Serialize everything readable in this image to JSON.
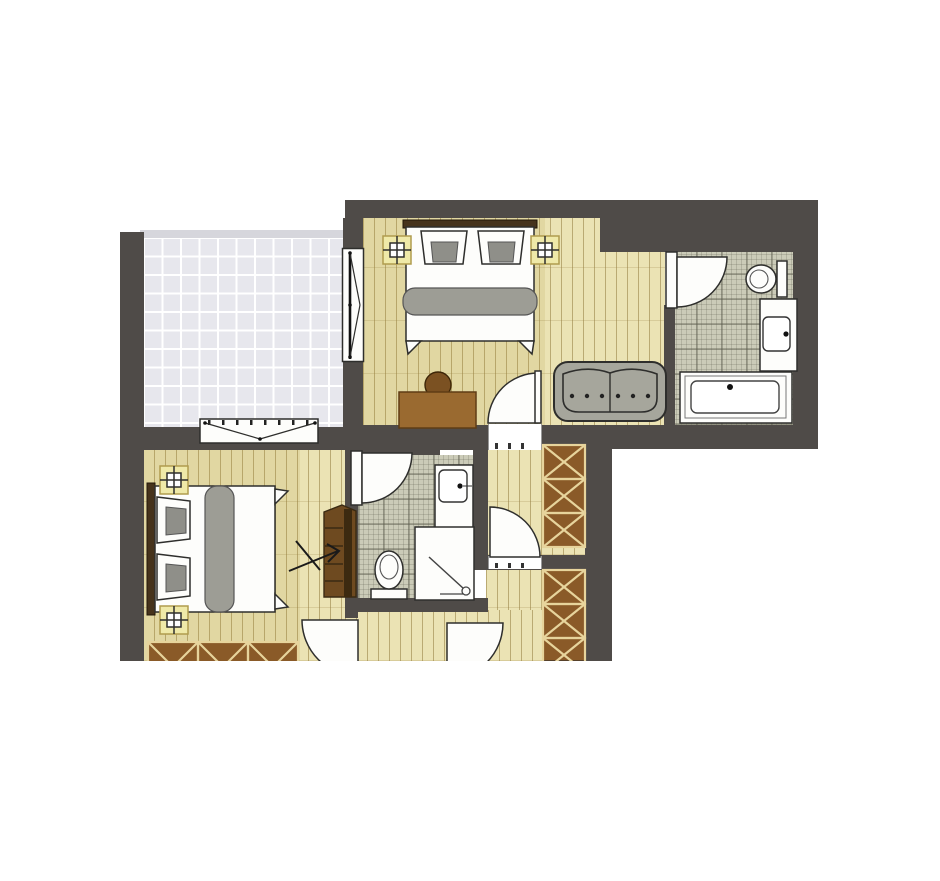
{
  "document": {
    "kind": "architectural-floor-plan",
    "visible_text": ""
  },
  "palette": {
    "wall": "#4f4b48",
    "outline": "#2e2e2c",
    "wood_floor": "#ebe3b4",
    "terrace_tile": "#e7e7ed",
    "bath_tile": "#cbcbb8",
    "fixture": "#fdfdfb",
    "textile": "#9d9d95",
    "sofa": "#a6a69c",
    "headboard": "#46331c",
    "desk": "#9a6a30",
    "chair": "#7b5122",
    "wardrobe": "#8a5a28",
    "wardrobe_hatch": "#e7d49c",
    "stairs": "#6e4a20",
    "light_fill": "#efe9a8",
    "light_border": "#b09c4e"
  },
  "rooms": [
    {
      "name": "terrace",
      "floor": "grey-tiles"
    },
    {
      "name": "bedroom-upper",
      "floor": "wood-planks"
    },
    {
      "name": "bathroom-upper",
      "floor": "checkered-tiles"
    },
    {
      "name": "bedroom-lower",
      "floor": "wood-planks"
    },
    {
      "name": "bathroom-lower",
      "floor": "checkered-tiles"
    },
    {
      "name": "hallway",
      "floor": "wood-planks"
    },
    {
      "name": "corridor",
      "floor": "wood-planks"
    }
  ],
  "furniture": [
    {
      "name": "double-bed",
      "room": "bedroom-upper"
    },
    {
      "name": "double-bed",
      "room": "bedroom-lower"
    },
    {
      "name": "sofa-two-seat",
      "room": "bedroom-upper"
    },
    {
      "name": "desk",
      "room": "bedroom-upper"
    },
    {
      "name": "chair",
      "room": "bedroom-upper"
    },
    {
      "name": "ceiling-light",
      "count": 4
    },
    {
      "name": "toilet",
      "count": 2
    },
    {
      "name": "washbasin-vanity",
      "count": 2
    },
    {
      "name": "bathtub",
      "room": "bathroom-upper"
    },
    {
      "name": "shower",
      "room": "bathroom-lower"
    },
    {
      "name": "wardrobe-hatched",
      "count": 3
    },
    {
      "name": "stairs-with-arrow",
      "room": "bedroom-lower"
    },
    {
      "name": "casement-window",
      "count": 2
    },
    {
      "name": "swing-door",
      "count": 6
    }
  ]
}
